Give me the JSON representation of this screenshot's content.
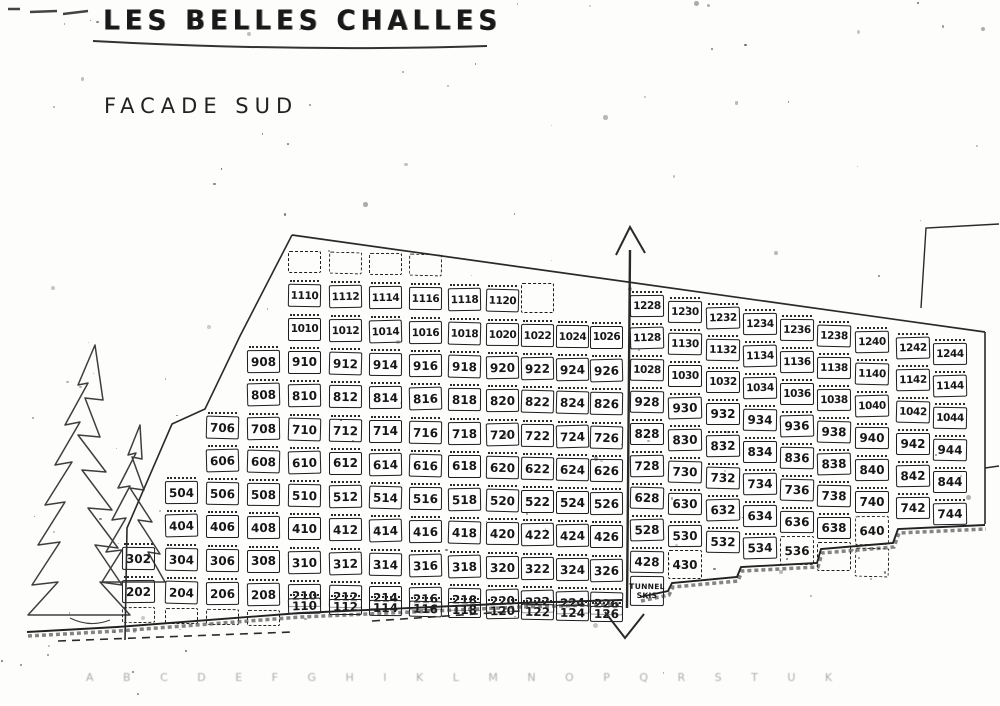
{
  "title": "LES BELLES CHALLES",
  "subtitle": "FACADE SUD",
  "tunnel": {
    "line1": "TUNNEL",
    "line2": "SKIS"
  },
  "bottom_ruler": "A B C D E F G H I K L M N O P Q R S T U K",
  "colors": {
    "ink": "#1c1c1c",
    "paper": "#fdfdfc"
  },
  "building": {
    "left_section": {
      "columns": [
        {
          "id": "02",
          "cells": [
            {
              "label": "302"
            },
            {
              "label": "202"
            },
            {
              "ghost": true,
              "floor": 1,
              "dashed": true
            }
          ]
        },
        {
          "id": "04",
          "cells": [
            {
              "label": "504"
            },
            {
              "label": "404"
            },
            {
              "label": "304"
            },
            {
              "label": "204"
            },
            {
              "ghost": true,
              "floor": 1,
              "dashed": true
            }
          ]
        },
        {
          "id": "06",
          "cells": [
            {
              "label": "706"
            },
            {
              "label": "606"
            },
            {
              "label": "506"
            },
            {
              "label": "406"
            },
            {
              "label": "306"
            },
            {
              "label": "206"
            },
            {
              "ghost": true,
              "floor": 1,
              "dashed": true
            }
          ]
        },
        {
          "id": "08",
          "cells": [
            {
              "label": "908"
            },
            {
              "label": "808"
            },
            {
              "label": "708"
            },
            {
              "label": "608"
            },
            {
              "label": "508"
            },
            {
              "label": "408"
            },
            {
              "label": "308"
            },
            {
              "label": "208"
            },
            {
              "ghost": true,
              "floor": 1,
              "dashed": true
            }
          ]
        },
        {
          "id": "10",
          "cells": [
            {
              "ghost": true,
              "floor": 12,
              "dashed": true
            },
            {
              "label": "1110"
            },
            {
              "label": "1010"
            },
            {
              "label": "910"
            },
            {
              "label": "810"
            },
            {
              "label": "710"
            },
            {
              "label": "610"
            },
            {
              "label": "510"
            },
            {
              "label": "410"
            },
            {
              "label": "310"
            },
            {
              "label": "210"
            },
            {
              "label": "110"
            }
          ]
        },
        {
          "id": "12",
          "cells": [
            {
              "ghost": true,
              "floor": 12,
              "dashed": true
            },
            {
              "label": "1112"
            },
            {
              "label": "1012"
            },
            {
              "label": "912"
            },
            {
              "label": "812"
            },
            {
              "label": "712"
            },
            {
              "label": "612"
            },
            {
              "label": "512"
            },
            {
              "label": "412"
            },
            {
              "label": "312"
            },
            {
              "label": "212"
            },
            {
              "label": "112"
            }
          ]
        },
        {
          "id": "14",
          "cells": [
            {
              "ghost": true,
              "floor": 12,
              "dashed": true
            },
            {
              "label": "1114"
            },
            {
              "label": "1014"
            },
            {
              "label": "914"
            },
            {
              "label": "814"
            },
            {
              "label": "714"
            },
            {
              "label": "614"
            },
            {
              "label": "514"
            },
            {
              "label": "414"
            },
            {
              "label": "314"
            },
            {
              "label": "214"
            },
            {
              "label": "114"
            }
          ]
        },
        {
          "id": "16",
          "cells": [
            {
              "ghost": true,
              "floor": 12,
              "dashed": true
            },
            {
              "label": "1116"
            },
            {
              "label": "1016"
            },
            {
              "label": "916"
            },
            {
              "label": "816"
            },
            {
              "label": "716"
            },
            {
              "label": "616"
            },
            {
              "label": "516"
            },
            {
              "label": "416"
            },
            {
              "label": "316"
            },
            {
              "label": "216"
            },
            {
              "label": "116"
            }
          ]
        },
        {
          "id": "18",
          "cells": [
            {
              "label": "1118"
            },
            {
              "label": "1018"
            },
            {
              "label": "918"
            },
            {
              "label": "818"
            },
            {
              "label": "718"
            },
            {
              "label": "618"
            },
            {
              "label": "518"
            },
            {
              "label": "418"
            },
            {
              "label": "318"
            },
            {
              "label": "218"
            },
            {
              "label": "118"
            }
          ]
        },
        {
          "id": "20",
          "cells": [
            {
              "label": "1120"
            },
            {
              "label": "1020"
            },
            {
              "label": "920"
            },
            {
              "label": "820"
            },
            {
              "label": "720"
            },
            {
              "label": "620"
            },
            {
              "label": "520"
            },
            {
              "label": "420"
            },
            {
              "label": "320"
            },
            {
              "label": "220"
            },
            {
              "label": "120"
            }
          ]
        },
        {
          "id": "22",
          "cells": [
            {
              "ghost": true,
              "floor": 11,
              "dashed": true
            },
            {
              "label": "1022"
            },
            {
              "label": "922"
            },
            {
              "label": "822"
            },
            {
              "label": "722"
            },
            {
              "label": "622"
            },
            {
              "label": "522"
            },
            {
              "label": "422"
            },
            {
              "label": "322"
            },
            {
              "label": "222"
            },
            {
              "label": "122"
            }
          ]
        },
        {
          "id": "24",
          "cells": [
            {
              "label": "1024"
            },
            {
              "label": "924"
            },
            {
              "label": "824"
            },
            {
              "label": "724"
            },
            {
              "label": "624"
            },
            {
              "label": "524"
            },
            {
              "label": "424"
            },
            {
              "label": "324"
            },
            {
              "label": "224"
            },
            {
              "label": "124"
            }
          ]
        },
        {
          "id": "26",
          "cells": [
            {
              "label": "1026"
            },
            {
              "label": "926"
            },
            {
              "label": "826"
            },
            {
              "label": "726"
            },
            {
              "label": "626"
            },
            {
              "label": "526"
            },
            {
              "label": "426"
            },
            {
              "label": "326"
            },
            {
              "label": "226"
            },
            {
              "label": "126"
            }
          ]
        }
      ]
    },
    "right_section": {
      "columns": [
        {
          "id": "28",
          "cells": [
            {
              "label": "1228"
            },
            {
              "label": "1128"
            },
            {
              "label": "1028"
            },
            {
              "label": "928"
            },
            {
              "label": "828"
            },
            {
              "label": "728"
            },
            {
              "label": "628"
            },
            {
              "label": "528"
            },
            {
              "label": "428"
            },
            {
              "tunnel": true,
              "floor": 3
            }
          ]
        },
        {
          "id": "30",
          "cells": [
            {
              "label": "1230"
            },
            {
              "label": "1130"
            },
            {
              "label": "1030"
            },
            {
              "label": "930"
            },
            {
              "label": "830"
            },
            {
              "label": "730"
            },
            {
              "label": "630"
            },
            {
              "label": "530"
            },
            {
              "label": "430",
              "dashed": true
            }
          ]
        },
        {
          "id": "32",
          "cells": [
            {
              "label": "1232"
            },
            {
              "label": "1132"
            },
            {
              "label": "1032"
            },
            {
              "label": "932"
            },
            {
              "label": "832"
            },
            {
              "label": "732"
            },
            {
              "label": "632"
            },
            {
              "label": "532"
            }
          ]
        },
        {
          "id": "34",
          "cells": [
            {
              "label": "1234"
            },
            {
              "label": "1134"
            },
            {
              "label": "1034"
            },
            {
              "label": "934"
            },
            {
              "label": "834"
            },
            {
              "label": "734"
            },
            {
              "label": "634"
            },
            {
              "label": "534"
            }
          ]
        },
        {
          "id": "36",
          "cells": [
            {
              "label": "1236"
            },
            {
              "label": "1136"
            },
            {
              "label": "1036"
            },
            {
              "label": "936"
            },
            {
              "label": "836"
            },
            {
              "label": "736"
            },
            {
              "label": "636"
            },
            {
              "label": "536",
              "dashed": true
            }
          ]
        },
        {
          "id": "38",
          "cells": [
            {
              "label": "1238"
            },
            {
              "label": "1138"
            },
            {
              "label": "1038"
            },
            {
              "label": "938"
            },
            {
              "label": "838"
            },
            {
              "label": "738"
            },
            {
              "label": "638"
            },
            {
              "ghost": true,
              "floor": 5,
              "dashed": true
            }
          ]
        },
        {
          "id": "40",
          "cells": [
            {
              "label": "1240"
            },
            {
              "label": "1140"
            },
            {
              "label": "1040"
            },
            {
              "label": "940"
            },
            {
              "label": "840"
            },
            {
              "label": "740"
            },
            {
              "label": "640",
              "dashed": true
            },
            {
              "ghost": true,
              "floor": 5,
              "dashed": true
            }
          ]
        },
        {
          "id": "42",
          "cells": [
            {
              "label": "1242"
            },
            {
              "label": "1142"
            },
            {
              "label": "1042"
            },
            {
              "label": "942"
            },
            {
              "label": "842"
            },
            {
              "label": "742"
            }
          ]
        },
        {
          "id": "44",
          "cells": [
            {
              "label": "1244"
            },
            {
              "label": "1144"
            },
            {
              "label": "1044"
            },
            {
              "label": "944"
            },
            {
              "label": "844"
            },
            {
              "label": "744"
            }
          ]
        }
      ]
    }
  }
}
